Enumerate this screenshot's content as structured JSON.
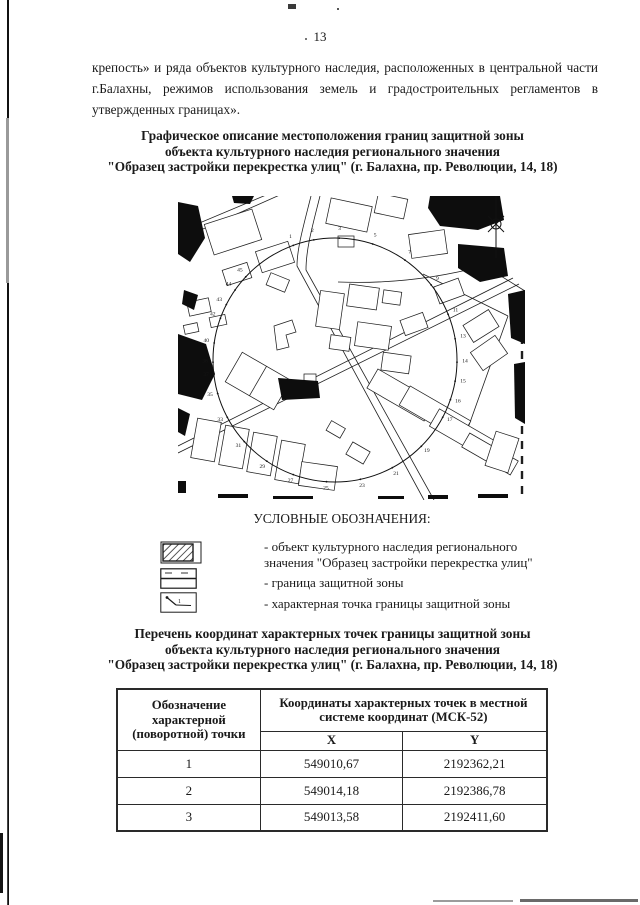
{
  "page": {
    "number": "13"
  },
  "paragraph": "крепость» и ряда объектов культурного наследия, расположенных в центральной части г.Балахны, режимов использования земель и градостроительных регламентов в утвержденных границах».",
  "map_title": {
    "lines": [
      "Графическое описание местоположения границ защитной зоны",
      "объекта культурного наследия регионального значения",
      "\"Образец застройки перекрестка улиц\" (г. Балахна, пр. Революции, 14, 18)"
    ]
  },
  "map": {
    "point_labels": [
      {
        "n": "1",
        "a": -20
      },
      {
        "n": "2",
        "a": -10
      },
      {
        "n": "3",
        "a": 2
      },
      {
        "n": "5",
        "a": 18
      },
      {
        "n": "7",
        "a": 35
      },
      {
        "n": "9",
        "a": 52
      },
      {
        "n": "11",
        "a": 68
      },
      {
        "n": "13",
        "a": 80
      },
      {
        "n": "14",
        "a": 91
      },
      {
        "n": "15",
        "a": 100
      },
      {
        "n": "16",
        "a": 109
      },
      {
        "n": "17",
        "a": 118
      },
      {
        "n": "19",
        "a": 135
      },
      {
        "n": "21",
        "a": 152
      },
      {
        "n": "23",
        "a": 168
      },
      {
        "n": "25",
        "a": 184
      },
      {
        "n": "27",
        "a": 200
      },
      {
        "n": "29",
        "a": 214
      },
      {
        "n": "31",
        "a": 228
      },
      {
        "n": "33",
        "a": 242
      },
      {
        "n": "35",
        "a": 254
      },
      {
        "n": "37",
        "a": 263
      },
      {
        "n": "38",
        "a": 269
      },
      {
        "n": "40",
        "a": 278
      },
      {
        "n": "42",
        "a": 290
      },
      {
        "n": "43",
        "a": 297
      },
      {
        "n": "44",
        "a": 305
      },
      {
        "n": "45",
        "a": 313
      }
    ]
  },
  "legend": {
    "title": "УСЛОВНЫЕ ОБОЗНАЧЕНИЯ:",
    "items": [
      {
        "lines": [
          "- объект культурного наследия регионального",
          "значения \"Образец застройки перекрестка улиц\""
        ]
      },
      {
        "lines": [
          "- граница защитной зоны"
        ]
      },
      {
        "lines": [
          "- характерная точка границы защитной зоны"
        ]
      }
    ]
  },
  "coords_title": {
    "lines": [
      "Перечень координат характерных точек границы защитной зоны",
      "объекта культурного наследия регионального значения",
      "\"Образец застройки перекрестка улиц\" (г. Балахна, пр. Революции, 14, 18)"
    ]
  },
  "table": {
    "header_point": "Обозначение характерной (поворотной) точки",
    "header_coords": "Координаты характерных точек в местной системе координат (МСК-52)",
    "header_x": "X",
    "header_y": "Y",
    "rows": [
      {
        "point": "1",
        "x": "549010,67",
        "y": "2192362,21"
      },
      {
        "point": "2",
        "x": "549014,18",
        "y": "2192386,78"
      },
      {
        "point": "3",
        "x": "549013,58",
        "y": "2192411,60"
      }
    ]
  },
  "colors": {
    "ink": "#1a1a1a",
    "paper": "#ffffff"
  }
}
